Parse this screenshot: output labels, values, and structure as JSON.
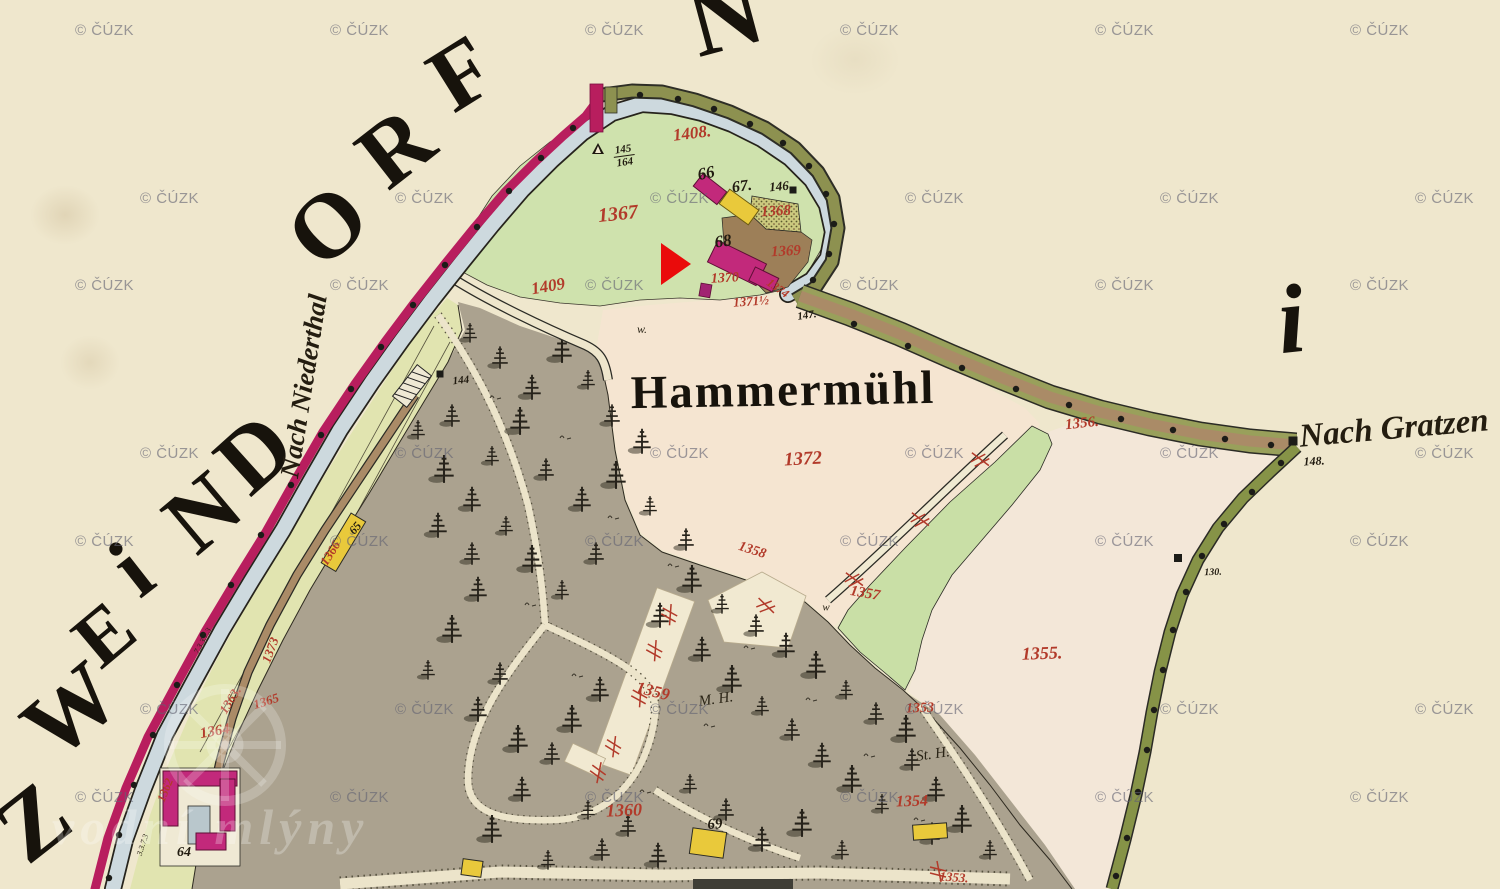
{
  "colors": {
    "paper": "#efe7cd",
    "meadow_green": "#cfe2ad",
    "strip_green": "#e1e4b0",
    "field_pink": "#f5e5d1",
    "field_pink_east": "#f3e7d8",
    "forest_gray": "#aba28f",
    "stream_blue": "#cdd9de",
    "road_crimson": "#b81e5e",
    "bank_olive": "#8d9150",
    "road_brown": "#aa8b67",
    "boundary_green": "#869347",
    "building_pink": "#c2297b",
    "building_yellow": "#e9c93b",
    "parcel_red": "#b23a2a",
    "ink_black": "#1c170e",
    "marker_red": "#ea0b0b",
    "watermark_gray": "#626273"
  },
  "watermark": {
    "text": "© ČÚZK",
    "rows": [
      {
        "y": 22,
        "xs": [
          75,
          330,
          585,
          840,
          1095,
          1350
        ]
      },
      {
        "y": 190,
        "xs": [
          140,
          395,
          650,
          905,
          1160,
          1415
        ]
      },
      {
        "y": 277,
        "xs": [
          75,
          330,
          585,
          840,
          1095,
          1350
        ]
      },
      {
        "y": 445,
        "xs": [
          140,
          395,
          650,
          905,
          1160,
          1415
        ]
      },
      {
        "y": 533,
        "xs": [
          75,
          330,
          585,
          840,
          1095,
          1350
        ]
      },
      {
        "y": 701,
        "xs": [
          140,
          395,
          650,
          905,
          1160,
          1415
        ]
      },
      {
        "y": 789,
        "xs": [
          75,
          330,
          585,
          840,
          1095,
          1350
        ]
      }
    ]
  },
  "site_watermark": {
    "text": "vodní mlýny"
  },
  "marker": {
    "shape": "arrow-right",
    "x": 661,
    "y": 243,
    "color": "#ea0b0b"
  },
  "big_letters": [
    {
      "ch": "Z",
      "x": 33,
      "y": 822,
      "rot": -38,
      "size": 95
    },
    {
      "ch": "W",
      "x": 70,
      "y": 710,
      "rot": -40,
      "size": 92
    },
    {
      "ch": "E",
      "x": 104,
      "y": 634,
      "rot": -40,
      "size": 78
    },
    {
      "ch": "i",
      "x": 132,
      "y": 570,
      "rot": -38,
      "size": 88
    },
    {
      "ch": "N",
      "x": 202,
      "y": 512,
      "rot": -40,
      "size": 92
    },
    {
      "ch": "D",
      "x": 254,
      "y": 453,
      "rot": -42,
      "size": 92
    },
    {
      "ch": "O",
      "x": 327,
      "y": 225,
      "rot": -43,
      "size": 92
    },
    {
      "ch": "R",
      "x": 395,
      "y": 147,
      "rot": -38,
      "size": 92
    },
    {
      "ch": "F",
      "x": 461,
      "y": 73,
      "rot": -32,
      "size": 92
    },
    {
      "ch": "N",
      "x": 725,
      "y": 16,
      "rot": -15,
      "size": 100
    },
    {
      "ch": "i",
      "x": 1291,
      "y": 320,
      "rot": -6,
      "size": 98,
      "italic": true
    }
  ],
  "place_labels": [
    {
      "text": "Hammermühl",
      "x": 783,
      "y": 391,
      "rot": -1,
      "size": 47,
      "style": "main"
    },
    {
      "text": "Nach Gratzen",
      "x": 1394,
      "y": 429,
      "rot": -5,
      "size": 33,
      "style": "cursive"
    },
    {
      "text": "Nach Niederthal",
      "x": 304,
      "y": 386,
      "rot": -81,
      "size": 27,
      "style": "cursive"
    }
  ],
  "red_numbers": [
    {
      "text": "1408.",
      "x": 692,
      "y": 133,
      "rot": -7,
      "size": 17
    },
    {
      "text": "1409",
      "x": 548,
      "y": 286,
      "rot": -10,
      "size": 17
    },
    {
      "text": "1367",
      "x": 618,
      "y": 214,
      "rot": -6,
      "size": 20
    },
    {
      "text": "1368",
      "x": 776,
      "y": 212,
      "rot": -3,
      "size": 15
    },
    {
      "text": "1369",
      "x": 786,
      "y": 252,
      "rot": -3,
      "size": 15
    },
    {
      "text": "1370",
      "x": 725,
      "y": 279,
      "rot": -3,
      "size": 14
    },
    {
      "text": "1371½",
      "x": 751,
      "y": 301,
      "rot": -4,
      "size": 13
    },
    {
      "text": "1374",
      "x": 778,
      "y": 288,
      "rot": 35,
      "size": 12
    },
    {
      "text": "1372",
      "x": 803,
      "y": 459,
      "rot": -3,
      "size": 19
    },
    {
      "text": "1356.",
      "x": 1082,
      "y": 424,
      "rot": -6,
      "size": 15
    },
    {
      "text": "1355.",
      "x": 1042,
      "y": 653,
      "rot": -2,
      "size": 18
    },
    {
      "text": "1357",
      "x": 865,
      "y": 594,
      "rot": 10,
      "size": 15
    },
    {
      "text": "1358",
      "x": 752,
      "y": 551,
      "rot": 18,
      "size": 14
    },
    {
      "text": "1359",
      "x": 653,
      "y": 691,
      "rot": 14,
      "size": 17
    },
    {
      "text": "1360",
      "x": 624,
      "y": 810,
      "rot": -2,
      "size": 18
    },
    {
      "text": "1354",
      "x": 912,
      "y": 802,
      "rot": -2,
      "size": 16
    },
    {
      "text": "1353",
      "x": 920,
      "y": 709,
      "rot": -2,
      "size": 14
    },
    {
      "text": "1353.",
      "x": 954,
      "y": 877,
      "rot": 4,
      "size": 13
    },
    {
      "text": "1366",
      "x": 330,
      "y": 553,
      "rot": -58,
      "size": 13
    },
    {
      "text": "1362",
      "x": 165,
      "y": 790,
      "rot": -68,
      "size": 12
    },
    {
      "text": "1363.",
      "x": 230,
      "y": 700,
      "rot": -58,
      "size": 13
    },
    {
      "text": "1364",
      "x": 215,
      "y": 732,
      "rot": -10,
      "size": 15
    },
    {
      "text": "1365",
      "x": 266,
      "y": 701,
      "rot": -18,
      "size": 13
    },
    {
      "text": "1373",
      "x": 270,
      "y": 650,
      "rot": -70,
      "size": 13
    }
  ],
  "black_numbers": [
    {
      "text": "66",
      "x": 706,
      "y": 173,
      "rot": -12,
      "size": 17
    },
    {
      "text": "67.",
      "x": 742,
      "y": 187,
      "rot": -8,
      "size": 16
    },
    {
      "text": "146",
      "x": 779,
      "y": 186,
      "rot": -5,
      "size": 13
    },
    {
      "text": "68",
      "x": 723,
      "y": 241,
      "rot": -8,
      "size": 17
    },
    {
      "text": "69",
      "x": 715,
      "y": 825,
      "rot": -4,
      "size": 15
    },
    {
      "text": "64",
      "x": 184,
      "y": 853,
      "rot": 0,
      "size": 14
    },
    {
      "text": "65",
      "x": 355,
      "y": 528,
      "rot": -50,
      "size": 12
    },
    {
      "text": "144",
      "x": 461,
      "y": 381,
      "rot": -6,
      "size": 11
    },
    {
      "text": "147.",
      "x": 807,
      "y": 316,
      "rot": -8,
      "size": 11
    },
    {
      "text": "148.",
      "x": 1314,
      "y": 461,
      "rot": -3,
      "size": 12
    },
    {
      "text": "130.",
      "x": 1213,
      "y": 573,
      "rot": -2,
      "size": 10
    }
  ],
  "small_notes": [
    {
      "text": "w.",
      "x": 642,
      "y": 329,
      "rot": 0,
      "size": 12
    },
    {
      "text": "w",
      "x": 826,
      "y": 608,
      "rot": 0,
      "size": 11
    },
    {
      "text": "M. H.",
      "x": 716,
      "y": 700,
      "rot": -8,
      "size": 15
    },
    {
      "text": "St. H.",
      "x": 933,
      "y": 755,
      "rot": -8,
      "size": 15
    },
    {
      "text": "7.3.3.7.3",
      "x": 203,
      "y": 641,
      "rot": -62,
      "size": 8
    },
    {
      "text": "3.3.7.3",
      "x": 143,
      "y": 845,
      "rot": -72,
      "size": 8
    }
  ],
  "point_fraction": {
    "top": "145",
    "bottom": "164",
    "x": 624,
    "y": 156,
    "rot": -8,
    "size": 11
  }
}
